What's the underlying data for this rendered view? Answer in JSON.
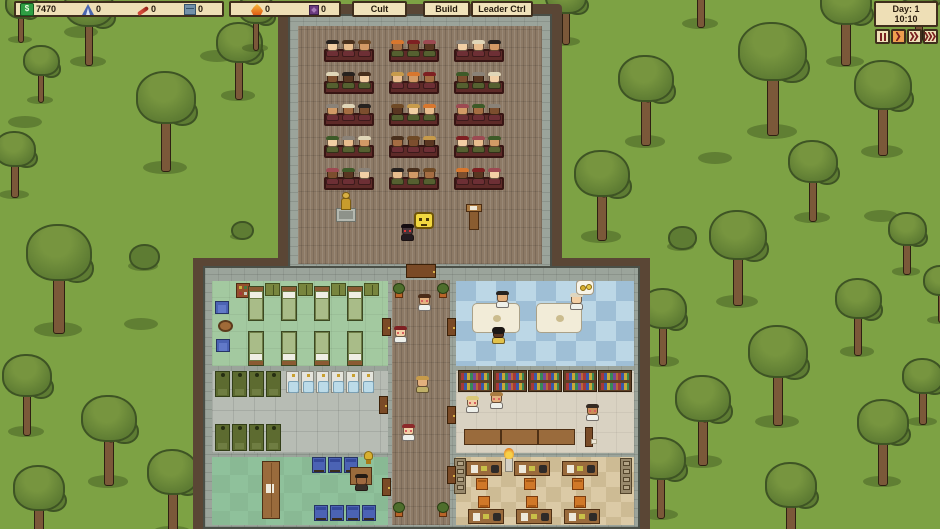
{
  "top_bar": {
    "resources": [
      {
        "id": "money",
        "glyph": "$",
        "value": "7470"
      },
      {
        "id": "tents",
        "value": "0"
      },
      {
        "id": "pens",
        "value": "0"
      },
      {
        "id": "crates",
        "value": "0"
      },
      {
        "id": "flame",
        "value": "0"
      },
      {
        "id": "runes",
        "value": "0"
      }
    ],
    "buttons": [
      {
        "label": "Cult"
      },
      {
        "label": "Build"
      },
      {
        "label": "Leader Ctrl"
      }
    ]
  },
  "time_panel": {
    "day_label": "Day: 1",
    "time": "10:10",
    "controls": [
      {
        "id": "pause",
        "active": false
      },
      {
        "id": "play",
        "active": true
      },
      {
        "id": "fast-forward",
        "active": false
      },
      {
        "id": "fastest-forward",
        "active": false
      }
    ]
  },
  "scene": {
    "colors": {
      "grass": "#7da244",
      "blob": "rgba(62,84,30,0.45)",
      "leaf": "#5e7c33",
      "leafDark": "#3e5424",
      "leafLight": "#77953f",
      "trunk": "#7b5839",
      "dirt": "#5a4635",
      "wall": "#9ba49b",
      "wallEdge": "#4a4f47",
      "plank": "#8d7a66",
      "bench": "#5e2a28",
      "benchEdge": "#371513"
    },
    "ground": {
      "trees": [
        [
          88,
          62,
          0.85
        ],
        [
          40,
          100,
          0.6
        ],
        [
          20,
          40,
          0.55
        ],
        [
          238,
          96,
          0.8
        ],
        [
          255,
          48,
          0.6
        ],
        [
          165,
          168,
          1.05
        ],
        [
          14,
          195,
          0.7
        ],
        [
          58,
          330,
          1.15
        ],
        [
          26,
          432,
          0.85
        ],
        [
          108,
          482,
          0.95
        ],
        [
          172,
          532,
          0.9
        ],
        [
          38,
          548,
          0.9
        ],
        [
          565,
          42,
          0.7
        ],
        [
          645,
          142,
          0.95
        ],
        [
          601,
          237,
          0.95
        ],
        [
          700,
          24,
          0.85
        ],
        [
          772,
          132,
          1.2
        ],
        [
          845,
          62,
          0.9
        ],
        [
          918,
          38,
          0.8
        ],
        [
          737,
          302,
          1.0
        ],
        [
          812,
          218,
          0.85
        ],
        [
          882,
          152,
          1.0
        ],
        [
          906,
          272,
          0.65
        ],
        [
          662,
          362,
          0.8
        ],
        [
          702,
          462,
          0.95
        ],
        [
          660,
          515,
          0.85
        ],
        [
          777,
          422,
          1.05
        ],
        [
          857,
          352,
          0.8
        ],
        [
          882,
          482,
          0.9
        ],
        [
          922,
          422,
          0.7
        ],
        [
          790,
          545,
          0.9
        ],
        [
          940,
          320,
          0.6
        ]
      ],
      "bushes": [
        [
          142,
          266,
          1
        ],
        [
          680,
          246,
          0.9
        ],
        [
          240,
          236,
          0.7
        ]
      ],
      "blobs": [
        [
          64,
          26
        ],
        [
          8,
          116
        ],
        [
          636,
          300
        ],
        [
          698,
          152
        ],
        [
          864,
          210
        ],
        [
          124,
          318
        ],
        [
          200,
          50
        ],
        [
          760,
          40
        ]
      ]
    },
    "rooms": [
      {
        "name": "dormitory-floor",
        "x": 212,
        "y": 281,
        "w": 176,
        "h": 85,
        "style": {
          "background": "#a3c9a0",
          "backgroundImage": "repeating-linear-gradient(0deg,rgba(0,0,0,.05) 0 1px,transparent 1px 17px),repeating-linear-gradient(90deg,rgba(0,0,0,.05) 0 1px,transparent 1px 17px)"
        }
      },
      {
        "name": "bathroom-floor",
        "x": 212,
        "y": 371,
        "w": 176,
        "h": 82,
        "style": {
          "background": "#b7bcb4",
          "backgroundImage": "repeating-linear-gradient(0deg,rgba(0,0,0,.09) 0 1px,transparent 1px 21px),repeating-linear-gradient(90deg,rgba(0,0,0,.09) 0 1px,transparent 1px 21px)"
        }
      },
      {
        "name": "waiting-room-floor",
        "x": 212,
        "y": 457,
        "w": 176,
        "h": 68,
        "style": {
          "background": "#8fc19b",
          "backgroundImage": "repeating-conic-gradient(rgba(0,0,0,.045) 0% 25%,transparent 0% 50%)",
          "backgroundSize": "36px 36px"
        }
      },
      {
        "name": "medical-room-floor",
        "x": 456,
        "y": 281,
        "w": 178,
        "h": 85,
        "style": {
          "background": "repeating-conic-gradient(#bcd7e6 0% 25%,#9fbfd6 0% 50%)",
          "backgroundSize": "40px 40px"
        }
      },
      {
        "name": "library-floor",
        "x": 456,
        "y": 371,
        "w": 178,
        "h": 82,
        "style": {
          "background": "#d9d2c2",
          "backgroundImage": "repeating-linear-gradient(0deg,rgba(0,0,0,.05) 0 1px,transparent 1px 20px),repeating-linear-gradient(90deg,rgba(0,0,0,.05) 0 1px,transparent 1px 20px)"
        }
      },
      {
        "name": "office-floor",
        "x": 456,
        "y": 457,
        "w": 178,
        "h": 68,
        "style": {
          "background": "repeating-conic-gradient(#dbcaa6 0% 25%,#cdbb94 0% 50%)",
          "backgroundSize": "30px 30px"
        }
      }
    ],
    "furniture": [
      {
        "t": "statueG",
        "x": 336,
        "y": 192
      },
      {
        "t": "bubbleFace",
        "x": 414,
        "y": 212
      },
      {
        "t": "podium",
        "x": 466,
        "y": 204
      },
      {
        "t": "shelf",
        "x": 236,
        "y": 283
      },
      {
        "t": "wardrobe",
        "x": 265,
        "y": 283
      },
      {
        "t": "wardrobe",
        "x": 298,
        "y": 283
      },
      {
        "t": "wardrobe",
        "x": 331,
        "y": 283
      },
      {
        "t": "wardrobe",
        "x": 364,
        "y": 283
      },
      {
        "t": "bed",
        "x": 248,
        "y": 286,
        "d": "d"
      },
      {
        "t": "bed",
        "x": 281,
        "y": 286,
        "d": "d"
      },
      {
        "t": "bed",
        "x": 314,
        "y": 286,
        "d": "d"
      },
      {
        "t": "bed",
        "x": 347,
        "y": 286,
        "d": "d"
      },
      {
        "t": "bed",
        "x": 248,
        "y": 331,
        "d": "u"
      },
      {
        "t": "bed",
        "x": 281,
        "y": 331,
        "d": "u"
      },
      {
        "t": "bed",
        "x": 314,
        "y": 331,
        "d": "u"
      },
      {
        "t": "bed",
        "x": 347,
        "y": 331,
        "d": "u"
      },
      {
        "t": "armchair",
        "x": 215,
        "y": 301
      },
      {
        "t": "armchair",
        "x": 216,
        "y": 339
      },
      {
        "t": "rtable",
        "x": 218,
        "y": 320
      },
      {
        "t": "shower",
        "x": 215,
        "y": 371,
        "h": 26
      },
      {
        "t": "shower",
        "x": 232,
        "y": 371,
        "h": 26
      },
      {
        "t": "shower",
        "x": 249,
        "y": 371,
        "h": 26
      },
      {
        "t": "shower",
        "x": 266,
        "y": 371,
        "h": 26
      },
      {
        "t": "toilet",
        "x": 286,
        "y": 371
      },
      {
        "t": "toilet",
        "x": 301,
        "y": 371
      },
      {
        "t": "toilet",
        "x": 316,
        "y": 371
      },
      {
        "t": "toilet",
        "x": 331,
        "y": 371
      },
      {
        "t": "toilet",
        "x": 346,
        "y": 371
      },
      {
        "t": "toilet",
        "x": 361,
        "y": 371
      },
      {
        "t": "shower",
        "x": 215,
        "y": 424,
        "h": 27
      },
      {
        "t": "shower",
        "x": 232,
        "y": 424,
        "h": 27
      },
      {
        "t": "shower",
        "x": 249,
        "y": 424,
        "h": 27
      },
      {
        "t": "shower",
        "x": 266,
        "y": 424,
        "h": 27
      },
      {
        "t": "counter",
        "x": 262,
        "y": 461
      },
      {
        "t": "chairB",
        "x": 312,
        "y": 457
      },
      {
        "t": "chairB",
        "x": 328,
        "y": 457
      },
      {
        "t": "chairB",
        "x": 344,
        "y": 457
      },
      {
        "t": "chairB",
        "x": 314,
        "y": 505
      },
      {
        "t": "chairB",
        "x": 330,
        "y": 505
      },
      {
        "t": "chairB",
        "x": 346,
        "y": 505
      },
      {
        "t": "chairB",
        "x": 362,
        "y": 505
      },
      {
        "t": "deskP",
        "x": 350,
        "y": 467,
        "w": 22,
        "h": 18
      },
      {
        "t": "trophy",
        "x": 363,
        "y": 451
      },
      {
        "t": "examTable",
        "x": 472,
        "y": 303,
        "w": 48
      },
      {
        "t": "examTable",
        "x": 536,
        "y": 303,
        "w": 46
      },
      {
        "t": "bubbleH",
        "x": 576,
        "y": 280
      },
      {
        "t": "bookshelf",
        "x": 458,
        "y": 370
      },
      {
        "t": "bookshelf",
        "x": 493,
        "y": 370
      },
      {
        "t": "bookshelf",
        "x": 528,
        "y": 370
      },
      {
        "t": "bookshelf",
        "x": 563,
        "y": 370
      },
      {
        "t": "bookshelf",
        "x": 598,
        "y": 370
      },
      {
        "t": "deskP",
        "x": 464,
        "y": 429,
        "w": 37,
        "h": 16
      },
      {
        "t": "deskP",
        "x": 501,
        "y": 429,
        "w": 37,
        "h": 16
      },
      {
        "t": "deskP",
        "x": 538,
        "y": 429,
        "w": 37,
        "h": 16
      },
      {
        "t": "lectern",
        "x": 582,
        "y": 427
      },
      {
        "t": "cab",
        "x": 454,
        "y": 458
      },
      {
        "t": "cab",
        "x": 620,
        "y": 458
      },
      {
        "t": "statueT",
        "x": 502,
        "y": 448
      },
      {
        "t": "deskT",
        "x": 466,
        "y": 461
      },
      {
        "t": "deskT",
        "x": 514,
        "y": 461
      },
      {
        "t": "deskT",
        "x": 562,
        "y": 461
      },
      {
        "t": "chairO",
        "x": 476,
        "y": 478
      },
      {
        "t": "chairO",
        "x": 524,
        "y": 478
      },
      {
        "t": "chairO",
        "x": 572,
        "y": 478
      },
      {
        "t": "chairO",
        "x": 478,
        "y": 496,
        "up": true
      },
      {
        "t": "chairO",
        "x": 526,
        "y": 496,
        "up": true
      },
      {
        "t": "chairO",
        "x": 574,
        "y": 496,
        "up": true
      },
      {
        "t": "deskT",
        "x": 468,
        "y": 509
      },
      {
        "t": "deskT",
        "x": 516,
        "y": 509
      },
      {
        "t": "deskT",
        "x": 564,
        "y": 509
      },
      {
        "t": "door",
        "x": 406,
        "y": 264,
        "w": 30,
        "h": 14
      },
      {
        "t": "plant",
        "x": 393,
        "y": 283
      },
      {
        "t": "plant",
        "x": 437,
        "y": 283
      },
      {
        "t": "plant",
        "x": 393,
        "y": 502
      },
      {
        "t": "plant",
        "x": 437,
        "y": 502
      },
      {
        "t": "door",
        "x": 382,
        "y": 318,
        "w": 9,
        "h": 18
      },
      {
        "t": "door",
        "x": 447,
        "y": 318,
        "w": 9,
        "h": 18
      },
      {
        "t": "door",
        "x": 379,
        "y": 396,
        "w": 9,
        "h": 18
      },
      {
        "t": "door",
        "x": 447,
        "y": 406,
        "w": 9,
        "h": 18
      },
      {
        "t": "door",
        "x": 382,
        "y": 478,
        "w": 9,
        "h": 18
      },
      {
        "t": "door",
        "x": 447,
        "y": 466,
        "w": 9,
        "h": 18
      }
    ],
    "people": [
      {
        "name": "cult-leader",
        "x": 401,
        "y": 224,
        "skin": "#44343a",
        "hair": "#150d12",
        "shirt": "#231a20",
        "eyes": "#e03636",
        "inter": true
      },
      {
        "name": "follower",
        "x": 418,
        "y": 294,
        "skin": "#e3b07e",
        "hair": "#4a2c18",
        "shirt": "#eef0ea",
        "eyes": "#d86060"
      },
      {
        "name": "follower",
        "x": 394,
        "y": 326,
        "skin": "#f2cfa5",
        "hair": "#7e2022",
        "shirt": "#eef0ea",
        "eyes": "#d86060"
      },
      {
        "name": "visitor",
        "x": 416,
        "y": 376,
        "skin": "#e3b07e",
        "hair": "#c79b4b",
        "shirt": "#c0b068"
      },
      {
        "name": "follower",
        "x": 402,
        "y": 424,
        "skin": "#f2cfa5",
        "hair": "#8c2a2a",
        "shirt": "#eef0ea",
        "eyes": "#d86060"
      },
      {
        "name": "doctor",
        "x": 496,
        "y": 291,
        "skin": "#e3b07e",
        "hair": "#27221f",
        "shirt": "#eef0ea"
      },
      {
        "name": "doctor",
        "x": 570,
        "y": 293,
        "skin": "#f2cfa5",
        "hair": "#ded6c0",
        "shirt": "#eef0ea"
      },
      {
        "name": "patient",
        "x": 492,
        "y": 327,
        "skin": "#5a3620",
        "hair": "#1c1714",
        "shirt": "#e2c24a",
        "afro": true
      },
      {
        "name": "reader",
        "x": 466,
        "y": 396,
        "skin": "#f2cfa5",
        "hair": "#d9c878",
        "shirt": "#eef0ea",
        "eyes": "#d86060"
      },
      {
        "name": "reader",
        "x": 490,
        "y": 392,
        "skin": "#e3b07e",
        "hair": "#a87c42",
        "shirt": "#eef0ea",
        "eyes": "#d86060"
      },
      {
        "name": "librarian",
        "x": 586,
        "y": 404,
        "skin": "#c98e5a",
        "hair": "#342a22",
        "shirt": "#eef0ea",
        "eyes": "#d86060"
      },
      {
        "name": "receptionist",
        "x": 355,
        "y": 474,
        "skin": "#a06a40",
        "hair": "#241b14",
        "shirt": "#3a3028"
      }
    ],
    "chapel": {
      "congregation": {
        "rows": [
          40,
          72,
          104,
          136,
          168
        ],
        "cols": [
          324,
          389,
          454
        ],
        "per_bench": 3,
        "palette": {
          "skins": [
            "#f2cfa5",
            "#e8bd8e",
            "#d29a66",
            "#a56d42",
            "#7c4e2e",
            "#593621"
          ],
          "hairs": [
            "#27221f",
            "#49301d",
            "#6f4a26",
            "#c79b4b",
            "#d8772e",
            "#7e2022",
            "#9c4a52",
            "#3d5a28",
            "#8a8278",
            "#e0d6b8"
          ],
          "shirts": [
            "#6d2f35",
            "#544026",
            "#3d4a68",
            "#556030",
            "#6a4a6e",
            "#303a30"
          ]
        }
      }
    }
  }
}
